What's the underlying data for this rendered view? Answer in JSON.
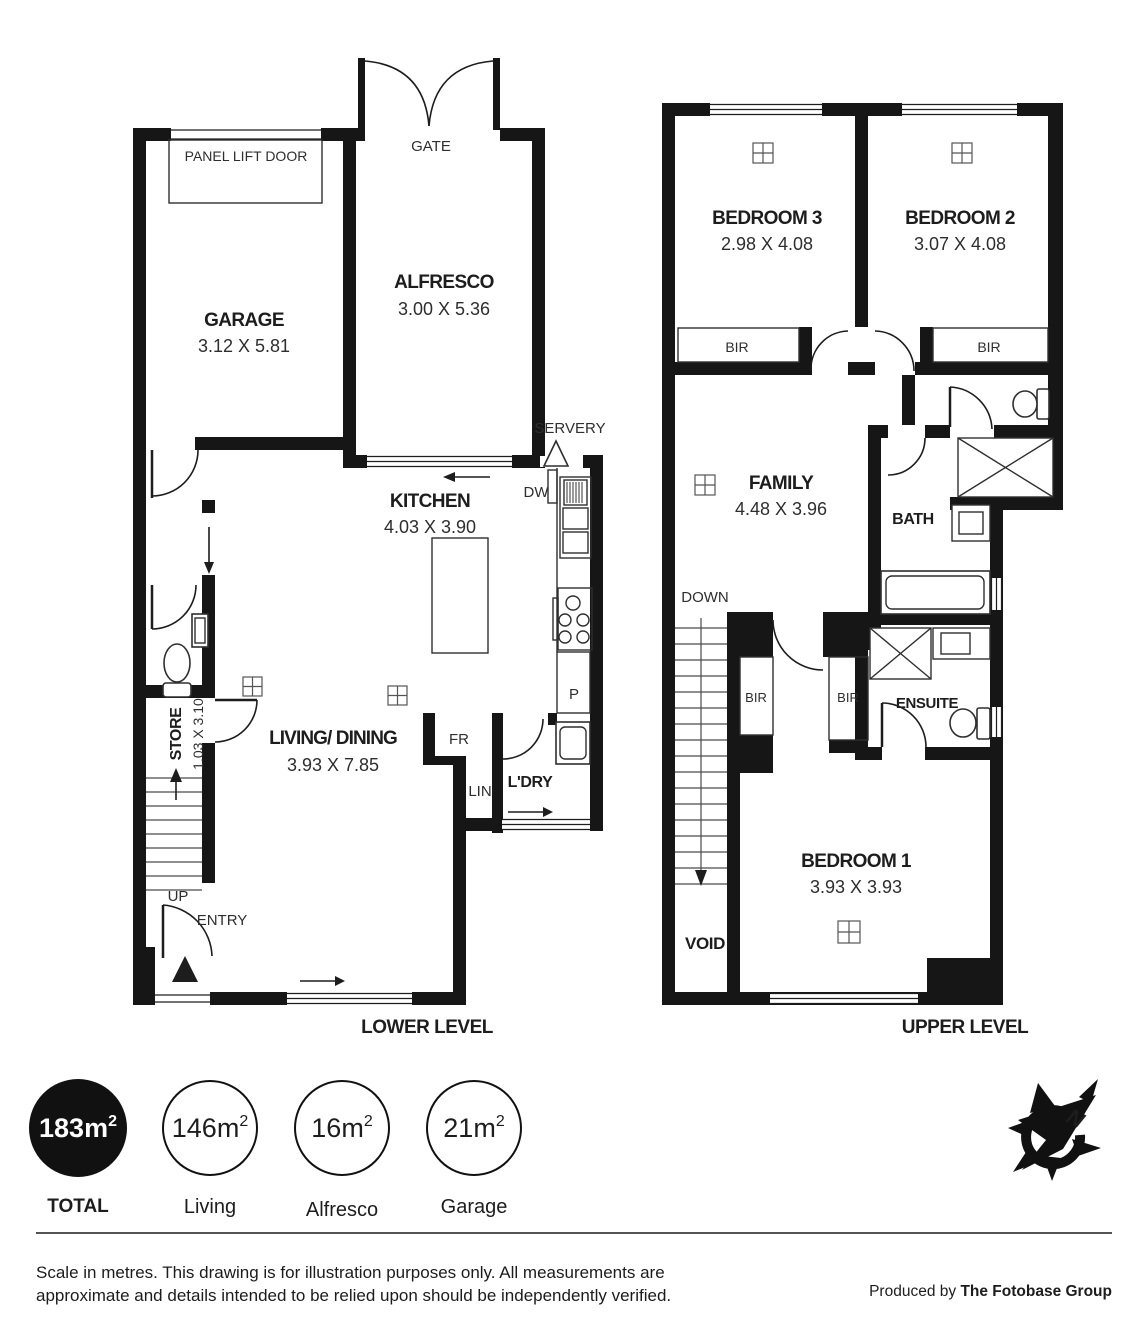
{
  "colors": {
    "ink": "#161616",
    "background": "#ffffff"
  },
  "plan": {
    "lower": {
      "title": "LOWER LEVEL",
      "rooms": {
        "garage": {
          "name": "GARAGE",
          "dims": "3.12 X 5.81"
        },
        "alfresco": {
          "name": "ALFRESCO",
          "dims": "3.00 X 5.36"
        },
        "kitchen": {
          "name": "KITCHEN",
          "dims": "4.03 X 3.90"
        },
        "living_dining": {
          "name": "LIVING/ DINING",
          "dims": "3.93 X 7.85"
        },
        "store": {
          "name": "STORE",
          "dims": "1.03 X 3.10"
        },
        "laundry": {
          "name": "L'DRY"
        }
      },
      "labels": {
        "panel_lift_door": "PANEL LIFT DOOR",
        "gate": "GATE",
        "servery": "SERVERY",
        "dishwasher": "DW",
        "pantry": "P",
        "fridge": "FR",
        "linen": "LIN",
        "up": "UP",
        "entry": "ENTRY"
      }
    },
    "upper": {
      "title": "UPPER LEVEL",
      "rooms": {
        "bedroom3": {
          "name": "BEDROOM 3",
          "dims": "2.98 X 4.08"
        },
        "bedroom2": {
          "name": "BEDROOM 2",
          "dims": "3.07 X 4.08"
        },
        "bedroom1": {
          "name": "BEDROOM 1",
          "dims": "3.93 X 3.93"
        },
        "family": {
          "name": "FAMILY",
          "dims": "4.48 X 3.96"
        },
        "bath": {
          "name": "BATH"
        },
        "ensuite": {
          "name": "ENSUITE"
        }
      },
      "labels": {
        "bir": "BIR",
        "down": "DOWN",
        "void": "VOID"
      }
    }
  },
  "areas": [
    {
      "value": "183m",
      "sup": "2",
      "label": "TOTAL",
      "filled": true
    },
    {
      "value": "146m",
      "sup": "2",
      "label": "Living",
      "filled": false
    },
    {
      "value": "16m",
      "sup": "2",
      "label": "Alfresco",
      "filled": false
    },
    {
      "value": "21m",
      "sup": "2",
      "label": "Garage",
      "filled": false
    }
  ],
  "compass": {
    "north_label": "N"
  },
  "footer": {
    "disclaimer_line1": "Scale in metres. This drawing is for illustration purposes only. All measurements are",
    "disclaimer_line2": "approximate and details intended to be relied upon should be independently verified.",
    "credit_prefix": "Produced by ",
    "credit_brand": "The Fotobase Group"
  }
}
